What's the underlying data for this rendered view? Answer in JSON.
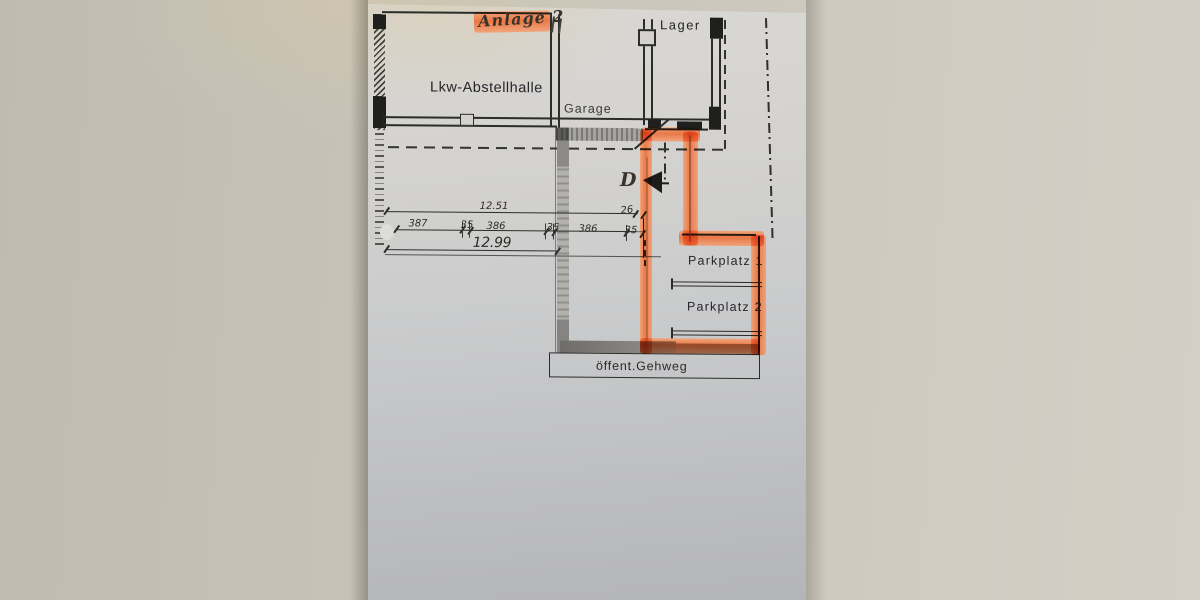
{
  "annotation": {
    "highlight_text": "Anlage 2"
  },
  "labels": {
    "hall": "Lkw-Abstellhalle",
    "garage": "Garage",
    "storage": "Lager",
    "parking1": "Parkplatz 1",
    "parking2": "Parkplatz 2",
    "sidewalk": "öffent.Gehweg",
    "door": "D"
  },
  "dimensions": {
    "upper_total": "12.51",
    "lower_total": "12.99",
    "offset": "26",
    "segments": [
      "387",
      "35",
      "386",
      "35",
      "386",
      "35"
    ]
  },
  "colors": {
    "highlighter": "#ef824d",
    "ink": "#2c2c2a",
    "paper": "#cdcdce",
    "background": "#c8c4ba"
  }
}
